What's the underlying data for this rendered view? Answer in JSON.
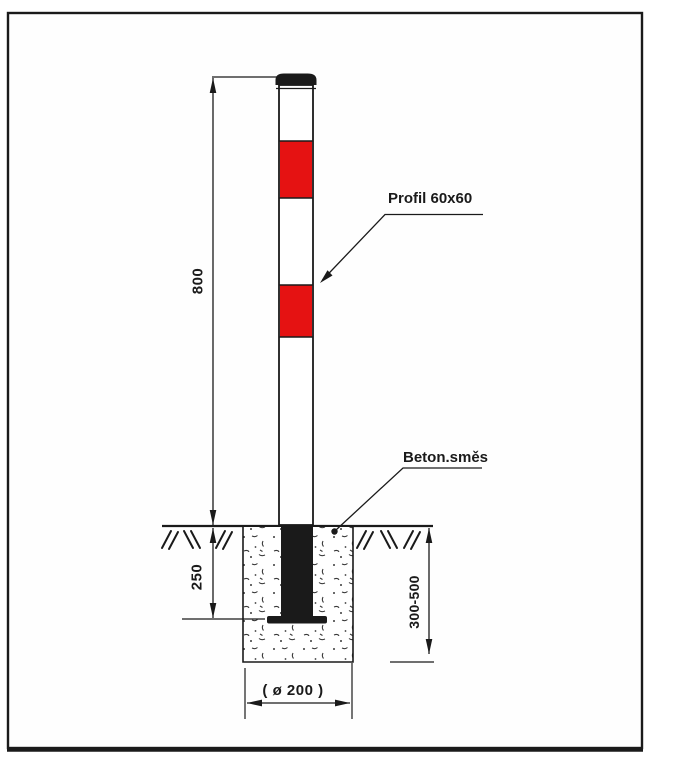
{
  "colors": {
    "red": "#e51212",
    "ink": "#1a1a1a"
  },
  "diagram": {
    "type": "bollard-installation-drawing",
    "callouts": {
      "profile": "Profil 60x60",
      "concrete": "Beton.směs"
    },
    "dimensions": {
      "above_ground": "800",
      "embedment": "250",
      "foundation_depth": "300-500",
      "foundation_diameter": "( ø 200 )"
    }
  }
}
